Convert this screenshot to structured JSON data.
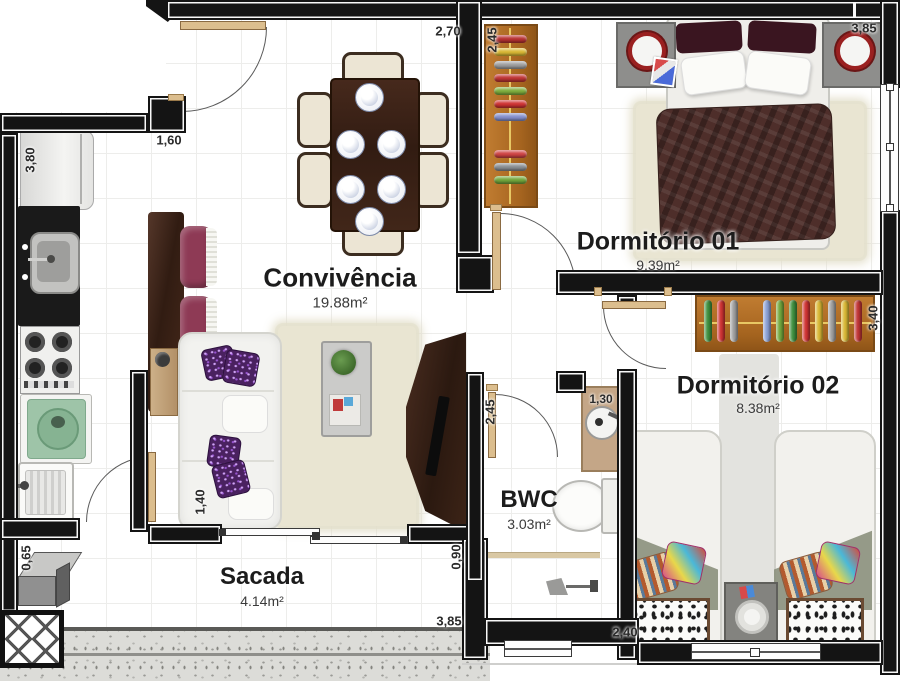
{
  "plan": {
    "type": "apartment-floor-plan",
    "rooms": [
      {
        "name": "Convivência",
        "area": "19.88m²"
      },
      {
        "name": "Dormitório 01",
        "area": "9.39m²"
      },
      {
        "name": "Dormitório 02",
        "area": "8.38m²"
      },
      {
        "name": "BWC",
        "area": "3.03m²"
      },
      {
        "name": "Sacada",
        "area": "4.14m²"
      }
    ],
    "dimensions": [
      {
        "value": "3,80",
        "orientation": "vertical",
        "location": "kitchen-left-wall"
      },
      {
        "value": "1,60",
        "orientation": "horizontal",
        "location": "entry-kitchen-width"
      },
      {
        "value": "2,70",
        "orientation": "horizontal",
        "location": "dining-top"
      },
      {
        "value": "2,45",
        "orientation": "vertical",
        "location": "dormitorio01-west"
      },
      {
        "value": "3,85",
        "orientation": "horizontal",
        "location": "dormitorio01-top"
      },
      {
        "value": "3,40",
        "orientation": "vertical",
        "location": "dormitorio02-east"
      },
      {
        "value": "1,30",
        "orientation": "horizontal",
        "location": "bwc-sink"
      },
      {
        "value": "2,45",
        "orientation": "vertical",
        "location": "bwc-west"
      },
      {
        "value": "1,40",
        "orientation": "vertical",
        "location": "sofa-wall"
      },
      {
        "value": "0,90",
        "orientation": "vertical",
        "location": "sacada-depth"
      },
      {
        "value": "0,65",
        "orientation": "vertical",
        "location": "service-nook"
      },
      {
        "value": "3,85",
        "orientation": "horizontal",
        "location": "sacada-bottom"
      },
      {
        "value": "2,40",
        "orientation": "horizontal",
        "location": "dormitorio02-bottom"
      }
    ],
    "colors": {
      "wall": "#141414",
      "wood_wardrobe": "#b9742c",
      "wood_dark": "#3a241c",
      "stool": "#8e3a55",
      "pillow_purple": "#4a2160",
      "duvet_brown": "#4e2e2a",
      "washer_green": "#9ec4a8",
      "lamp_ring_red": "#9a2020",
      "counter_tan": "#c4a687"
    },
    "decor": {
      "wardrobe1_clothes": [
        "#b93232",
        "#d9b835",
        "#9f9f9f",
        "#c03535",
        "#7fae3e",
        "#cf3333",
        "#8590cc",
        null,
        "#cf4444",
        "#8a8f94",
        "#72a63c"
      ],
      "wardrobe2_clothes": [
        "#3f8f3f",
        "#cf3333",
        "#9f9f9f",
        null,
        "#8aa0d4",
        "#72a63c",
        "#3f8f3f",
        "#cf3333",
        "#d9b835",
        "#9f9f9f",
        "#d9b835",
        "#c03535"
      ]
    }
  }
}
